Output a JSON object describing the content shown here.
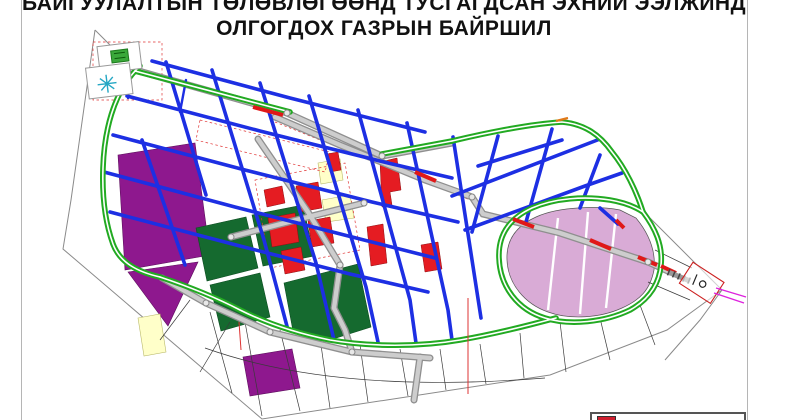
{
  "title": {
    "line1": "БАЙГУУЛАЛТЫН ТӨЛӨВЛӨГӨӨНД ТУСГАГДСАН ЭХНИЙ ЭЭЛЖИНД",
    "line2": "ОЛГОГДОХ ГАЗРЫН БАЙРШИЛ"
  },
  "legend": {
    "first_swatch_color": "#cf1f2f"
  },
  "colors": {
    "purple": "#8e188e",
    "dgreen": "#156a2f",
    "red": "#e51c22",
    "plum": "#d9abd6",
    "pyellow": "#ffffc9",
    "blue": "#1d2fe3",
    "green": "#22aa22",
    "magenta": "#dd22dd",
    "lred": "#cf1f2f"
  },
  "icons": {
    "topleft_box1": "green-building-icon",
    "topleft_box2": "cyan-star-icon",
    "exit_plate": "site-exit-plate-icon"
  }
}
